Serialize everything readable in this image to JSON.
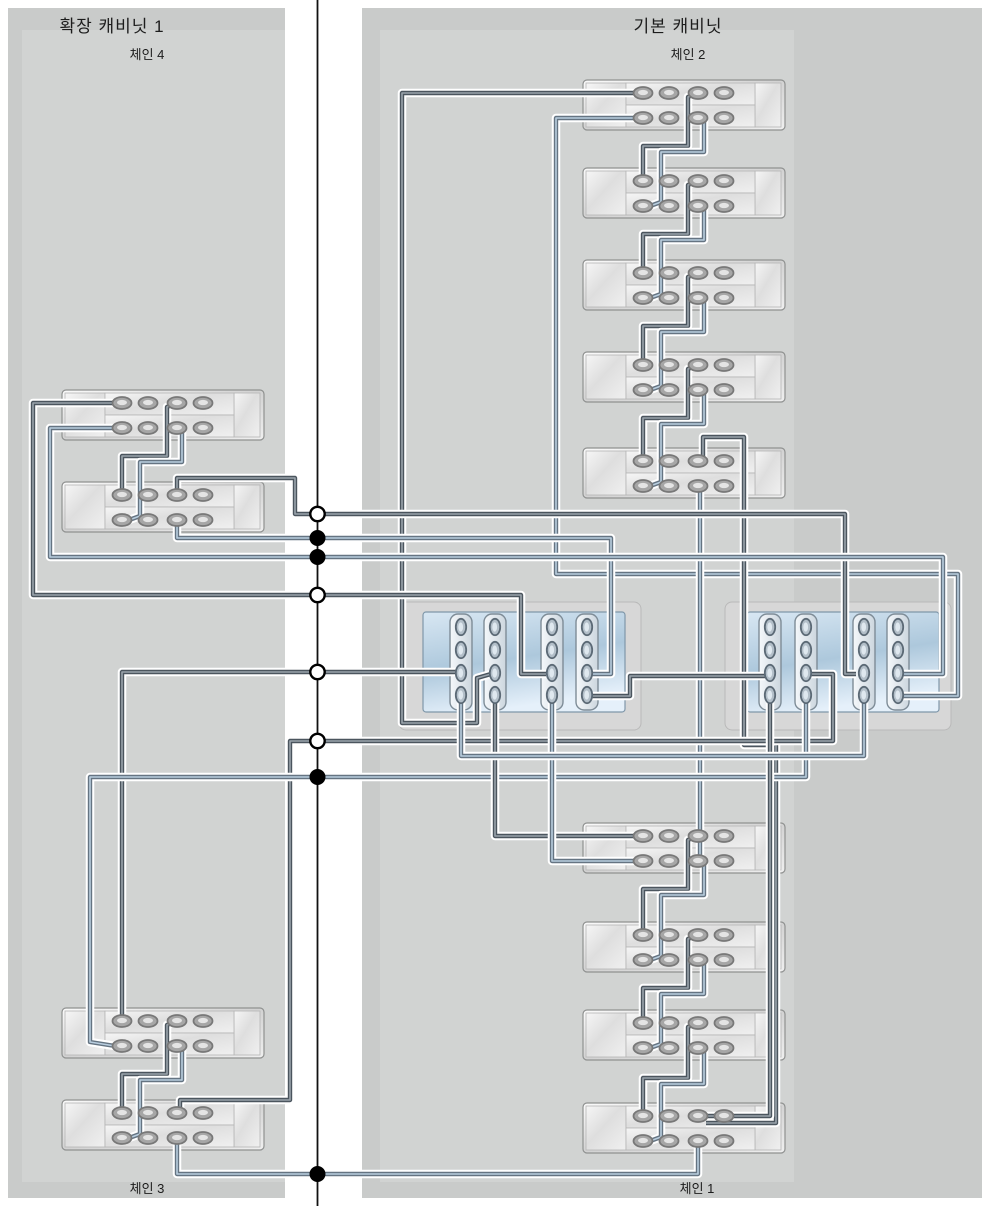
{
  "labels": {
    "left_title": "확장 캐비닛 1",
    "left_top_chain": "체인 4",
    "left_bottom_chain": "체인 3",
    "right_title": "기본 캐비닛",
    "right_top_chain": "체인 2",
    "right_bottom_chain": "체인 1"
  },
  "label_pos": {
    "left_title": {
      "x": 112,
      "y": 12
    },
    "left_top_chain": {
      "x": 147,
      "y": 44
    },
    "left_bottom_chain": {
      "x": 147,
      "y": 1178
    },
    "right_title": {
      "x": 678,
      "y": 12
    },
    "right_top_chain": {
      "x": 688,
      "y": 44
    },
    "right_bottom_chain": {
      "x": 697,
      "y": 1178
    }
  },
  "style": {
    "page_bg": "#ffffff",
    "panel": "#c9cbca",
    "panel_inner": "#d1d3d2",
    "divider_line": "#111111",
    "cable_halo": "#ffffff",
    "cable_dark_core": "#4b555e",
    "cable_dark_center": "#9aa4ac",
    "cable_blue_core": "#657482",
    "cable_blue_center": "#b9cedf",
    "shelf_stroke": "#8f9190",
    "port_ring": "#787878",
    "port_fill": "#a6a6a6",
    "port_center": "#e4e4e4",
    "ctrl_outer": "#d7d7d7",
    "ctrl_outer_stroke": "#b9b9b9",
    "ctrl_blue_stroke": "#7f97a9",
    "card_stroke": "#7e8c97",
    "ctrl_port_fill": "#b3bfc9",
    "ctrl_port_ring": "#5c6a76",
    "ctrl_port_center": "#dfe8ef"
  },
  "panels": {
    "left": [
      8,
      8,
      277,
      1190
    ],
    "right": [
      362,
      8,
      620,
      1190
    ],
    "left_inner": [
      22,
      30,
      263,
      1152
    ],
    "right_inner": [
      380,
      30,
      414,
      1152
    ]
  },
  "divider": {
    "x": 317.5,
    "dots": [
      {
        "y": 514,
        "type": "open"
      },
      {
        "y": 538,
        "type": "filled"
      },
      {
        "y": 557,
        "type": "filled"
      },
      {
        "y": 595,
        "type": "open"
      },
      {
        "y": 672,
        "type": "open"
      },
      {
        "y": 741,
        "type": "open"
      },
      {
        "y": 777,
        "type": "filled"
      },
      {
        "y": 1174,
        "type": "filled"
      }
    ]
  },
  "shelf_geom": {
    "w": 202,
    "h": 50,
    "port_dx": [
      60,
      86,
      115,
      141
    ],
    "row_dy": [
      13,
      38
    ]
  },
  "shelves": [
    {
      "id": "chain2-shelf1",
      "x": 583,
      "y": 80
    },
    {
      "id": "chain2-shelf2",
      "x": 583,
      "y": 168
    },
    {
      "id": "chain2-shelf3",
      "x": 583,
      "y": 260
    },
    {
      "id": "chain2-shelf4",
      "x": 583,
      "y": 352
    },
    {
      "id": "chain2-shelf5",
      "x": 583,
      "y": 448
    },
    {
      "id": "chain1-shelf1",
      "x": 583,
      "y": 823
    },
    {
      "id": "chain1-shelf2",
      "x": 583,
      "y": 922
    },
    {
      "id": "chain1-shelf3",
      "x": 583,
      "y": 1010
    },
    {
      "id": "chain1-shelf4",
      "x": 583,
      "y": 1103
    },
    {
      "id": "chain4-shelf1",
      "x": 62,
      "y": 390
    },
    {
      "id": "chain4-shelf2",
      "x": 62,
      "y": 482
    },
    {
      "id": "chain3-shelf1",
      "x": 62,
      "y": 1008
    },
    {
      "id": "chain3-shelf2",
      "x": 62,
      "y": 1100
    }
  ],
  "controllers": [
    {
      "id": "controller-1",
      "outer": [
        399,
        602,
        242,
        128
      ],
      "blue": [
        423,
        612,
        202,
        100
      ],
      "cards": [
        461,
        495,
        552,
        587
      ],
      "port_ys": [
        627,
        650,
        673,
        695
      ]
    },
    {
      "id": "controller-2",
      "outer": [
        725,
        602,
        226,
        128
      ],
      "blue": [
        747,
        612,
        192,
        100
      ],
      "cards": [
        770,
        806,
        864,
        898
      ],
      "port_ys": [
        627,
        650,
        673,
        695
      ]
    }
  ],
  "cables": [
    {
      "n": "chain2-stair1-dark",
      "c": "dark",
      "p": [
        [
          643,
          181
        ],
        [
          643,
          146
        ],
        [
          688,
          146
        ],
        [
          688,
          97
        ],
        [
          697,
          93
        ]
      ]
    },
    {
      "n": "chain2-stair1-blue",
      "c": "blue",
      "p": [
        [
          704,
          120
        ],
        [
          704,
          152
        ],
        [
          661,
          152
        ],
        [
          661,
          202
        ],
        [
          650,
          206
        ]
      ]
    },
    {
      "n": "chain2-stair2-dark",
      "c": "dark",
      "p": [
        [
          643,
          273
        ],
        [
          643,
          234
        ],
        [
          688,
          234
        ],
        [
          688,
          185
        ],
        [
          697,
          181
        ]
      ]
    },
    {
      "n": "chain2-stair2-blue",
      "c": "blue",
      "p": [
        [
          704,
          208
        ],
        [
          704,
          240
        ],
        [
          661,
          240
        ],
        [
          661,
          294
        ],
        [
          650,
          298
        ]
      ]
    },
    {
      "n": "chain2-stair3-dark",
      "c": "dark",
      "p": [
        [
          643,
          365
        ],
        [
          643,
          326
        ],
        [
          688,
          326
        ],
        [
          688,
          277
        ],
        [
          697,
          273
        ]
      ]
    },
    {
      "n": "chain2-stair3-blue",
      "c": "blue",
      "p": [
        [
          704,
          300
        ],
        [
          704,
          332
        ],
        [
          661,
          332
        ],
        [
          661,
          386
        ],
        [
          650,
          390
        ]
      ]
    },
    {
      "n": "chain2-stair4-dark",
      "c": "dark",
      "p": [
        [
          643,
          461
        ],
        [
          643,
          418
        ],
        [
          688,
          418
        ],
        [
          688,
          369
        ],
        [
          697,
          365
        ]
      ]
    },
    {
      "n": "chain2-stair4-blue",
      "c": "blue",
      "p": [
        [
          704,
          392
        ],
        [
          704,
          424
        ],
        [
          661,
          424
        ],
        [
          661,
          482
        ],
        [
          650,
          486
        ]
      ]
    },
    {
      "n": "chain1-stair1-dark",
      "c": "dark",
      "p": [
        [
          643,
          935
        ],
        [
          643,
          889
        ],
        [
          688,
          889
        ],
        [
          688,
          840
        ],
        [
          697,
          836
        ]
      ]
    },
    {
      "n": "chain1-stair1-blue",
      "c": "blue",
      "p": [
        [
          704,
          863
        ],
        [
          704,
          895
        ],
        [
          661,
          895
        ],
        [
          661,
          956
        ],
        [
          650,
          960
        ]
      ]
    },
    {
      "n": "chain1-stair2-dark",
      "c": "dark",
      "p": [
        [
          643,
          1023
        ],
        [
          643,
          988
        ],
        [
          688,
          988
        ],
        [
          688,
          939
        ],
        [
          697,
          935
        ]
      ]
    },
    {
      "n": "chain1-stair2-blue",
      "c": "blue",
      "p": [
        [
          704,
          962
        ],
        [
          704,
          994
        ],
        [
          661,
          994
        ],
        [
          661,
          1044
        ],
        [
          650,
          1048
        ]
      ]
    },
    {
      "n": "chain1-stair3-dark",
      "c": "dark",
      "p": [
        [
          643,
          1116
        ],
        [
          643,
          1078
        ],
        [
          688,
          1078
        ],
        [
          688,
          1027
        ],
        [
          697,
          1023
        ]
      ]
    },
    {
      "n": "chain1-stair3-blue",
      "c": "blue",
      "p": [
        [
          704,
          1050
        ],
        [
          704,
          1084
        ],
        [
          661,
          1084
        ],
        [
          661,
          1137
        ],
        [
          650,
          1141
        ]
      ]
    },
    {
      "n": "chain4-stair-dark",
      "c": "dark",
      "p": [
        [
          122,
          495
        ],
        [
          122,
          456
        ],
        [
          167,
          456
        ],
        [
          167,
          407
        ],
        [
          176,
          403
        ]
      ]
    },
    {
      "n": "chain4-stair-blue",
      "c": "blue",
      "p": [
        [
          182,
          430
        ],
        [
          182,
          462
        ],
        [
          140,
          462
        ],
        [
          140,
          516
        ],
        [
          129,
          520
        ]
      ]
    },
    {
      "n": "chain3-stair-dark",
      "c": "dark",
      "p": [
        [
          122,
          1113
        ],
        [
          122,
          1074
        ],
        [
          167,
          1074
        ],
        [
          167,
          1025
        ],
        [
          176,
          1021
        ]
      ]
    },
    {
      "n": "chain3-stair-blue",
      "c": "blue",
      "p": [
        [
          182,
          1048
        ],
        [
          182,
          1080
        ],
        [
          140,
          1080
        ],
        [
          140,
          1134
        ],
        [
          129,
          1138
        ]
      ]
    },
    {
      "n": "link-c2s1-ctrl1",
      "c": "dark",
      "p": [
        [
          643,
          93
        ],
        [
          402,
          93
        ],
        [
          402,
          723
        ],
        [
          477,
          723
        ],
        [
          477,
          678
        ],
        [
          491,
          674
        ]
      ]
    },
    {
      "n": "link-c2s1-ctrl2",
      "c": "blue",
      "p": [
        [
          643,
          118
        ],
        [
          556,
          118
        ],
        [
          556,
          574
        ],
        [
          958,
          574
        ],
        [
          958,
          696
        ],
        [
          902,
          696
        ]
      ]
    },
    {
      "n": "link-c4s1-ctrl1",
      "c": "dark",
      "p": [
        [
          122,
          403
        ],
        [
          33,
          403
        ],
        [
          33,
          595
        ],
        [
          521,
          595
        ],
        [
          521,
          674
        ],
        [
          546,
          674
        ]
      ]
    },
    {
      "n": "link-c2s5-loop",
      "c": "dark",
      "p": [
        [
          703,
          459
        ],
        [
          703,
          437
        ],
        [
          744,
          437
        ],
        [
          744,
          745
        ],
        [
          776,
          745
        ],
        [
          776,
          1123
        ],
        [
          706,
          1123
        ]
      ]
    },
    {
      "n": "link-c2s5-c1s1",
      "c": "blue",
      "p": [
        [
          700,
          487
        ],
        [
          700,
          858
        ]
      ]
    },
    {
      "n": "link-c4s2-ctrl2",
      "c": "dark",
      "p": [
        [
          177,
          495
        ],
        [
          177,
          478
        ],
        [
          295,
          478
        ],
        [
          295,
          514
        ],
        [
          845,
          514
        ],
        [
          845,
          674
        ],
        [
          856,
          674
        ]
      ]
    },
    {
      "n": "link-c4s2-ctrl1",
      "c": "blue",
      "p": [
        [
          177,
          521
        ],
        [
          177,
          538
        ],
        [
          611,
          538
        ],
        [
          611,
          674
        ],
        [
          592,
          674
        ]
      ]
    },
    {
      "n": "link-c4s1-ctrl2",
      "c": "blue",
      "p": [
        [
          122,
          428
        ],
        [
          50,
          428
        ],
        [
          50,
          557
        ],
        [
          943,
          557
        ],
        [
          943,
          674
        ],
        [
          903,
          674
        ]
      ]
    },
    {
      "n": "link-c3s1-ctrl1",
      "c": "dark",
      "p": [
        [
          122,
          1019
        ],
        [
          122,
          672
        ],
        [
          456,
          672
        ]
      ]
    },
    {
      "n": "link-ctrl2-c3s2",
      "c": "dark",
      "p": [
        [
          806,
          674
        ],
        [
          833,
          674
        ],
        [
          833,
          741
        ],
        [
          290,
          741
        ],
        [
          290,
          1100
        ],
        [
          180,
          1100
        ],
        [
          180,
          1109
        ]
      ]
    },
    {
      "n": "link-ctrl2-c3s1",
      "c": "blue",
      "p": [
        [
          806,
          696
        ],
        [
          806,
          777
        ],
        [
          90,
          777
        ],
        [
          90,
          1042
        ],
        [
          115,
          1046
        ]
      ]
    },
    {
      "n": "link-c3s2-c1s4",
      "c": "blue",
      "p": [
        [
          177,
          1140
        ],
        [
          177,
          1174
        ],
        [
          698,
          1174
        ],
        [
          698,
          1143
        ]
      ]
    },
    {
      "n": "link-ctrl1-c1s1-top",
      "c": "dark",
      "p": [
        [
          495,
          696
        ],
        [
          495,
          836
        ],
        [
          640,
          836
        ]
      ]
    },
    {
      "n": "link-ctrl1-c1s1-bot",
      "c": "blue",
      "p": [
        [
          552,
          696
        ],
        [
          552,
          861
        ],
        [
          640,
          861
        ]
      ]
    },
    {
      "n": "link-ctrl1-ctrl2",
      "c": "dark",
      "p": [
        [
          587,
          696
        ],
        [
          630,
          696
        ],
        [
          630,
          676
        ],
        [
          765,
          676
        ]
      ]
    },
    {
      "n": "link-ctrl2-c1s4",
      "c": "dark",
      "p": [
        [
          770,
          696
        ],
        [
          770,
          1116
        ],
        [
          705,
          1116
        ]
      ]
    },
    {
      "n": "link-ctrl1-ctrl2-low",
      "c": "blue",
      "p": [
        [
          461,
          696
        ],
        [
          461,
          756
        ],
        [
          864,
          756
        ],
        [
          864,
          699
        ]
      ]
    }
  ]
}
